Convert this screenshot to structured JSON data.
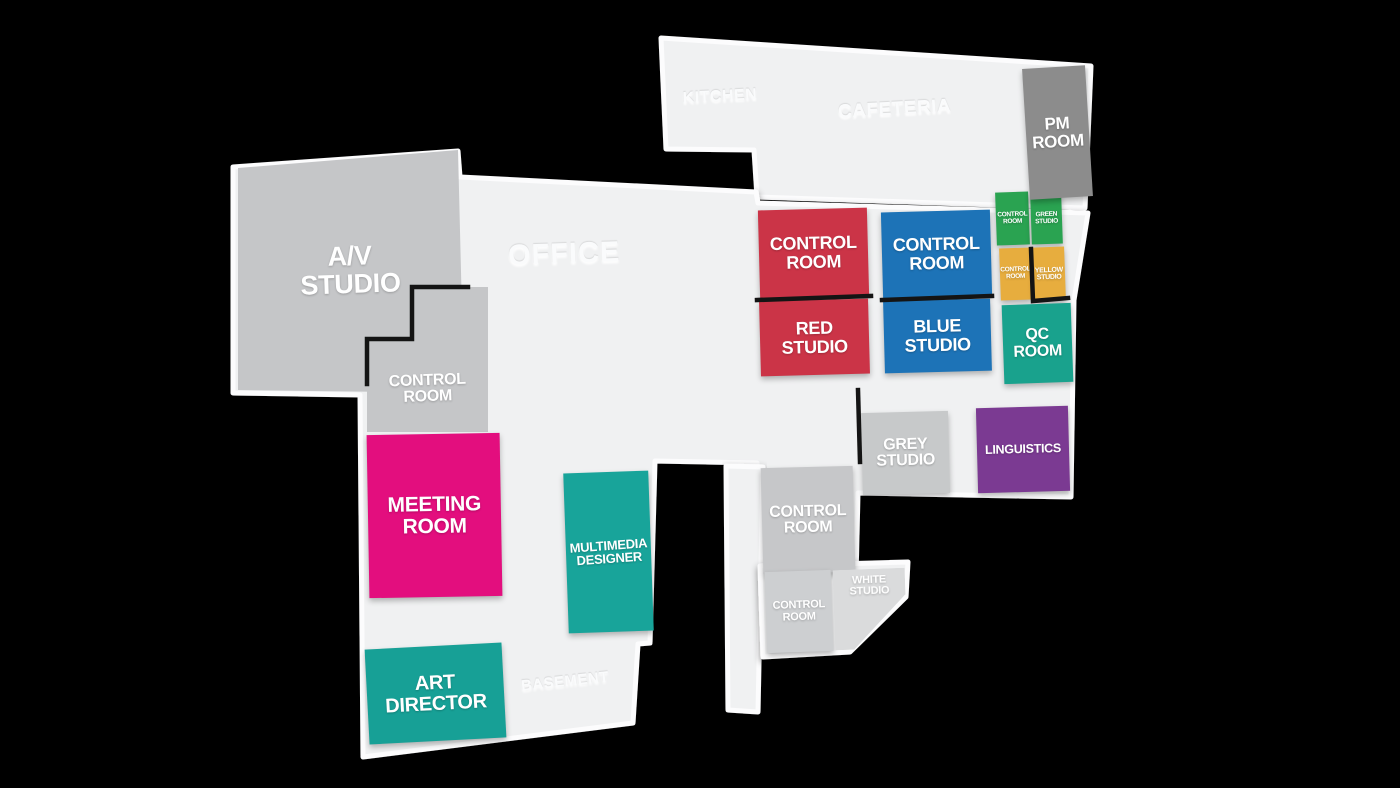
{
  "colors": {
    "background": "#000000",
    "floor": "#f0f1f2",
    "floor_edge": "#fcfcfd",
    "wall": "#141414"
  },
  "areas": {
    "kitchen": {
      "label": "KITCHEN"
    },
    "cafeteria": {
      "label": "CAFETERIA"
    },
    "office": {
      "label": "OFFICE"
    },
    "basement": {
      "label": "BASEMENT"
    }
  },
  "rooms": {
    "av_studio": {
      "label": "A/V\nSTUDIO",
      "color": "#c5c6c8"
    },
    "control_av": {
      "label": "CONTROL\nROOM",
      "color": "#c5c6c8"
    },
    "meeting_room": {
      "label": "MEETING\nROOM",
      "color": "#e30e7e"
    },
    "art_director": {
      "label": "ART\nDIRECTOR",
      "color": "#17a096"
    },
    "multimedia_designer": {
      "label": "MULTIMEDIA\nDESIGNER",
      "color": "#18a49a"
    },
    "control_red": {
      "label": "CONTROL\nROOM",
      "color": "#cb3447"
    },
    "red_studio": {
      "label": "RED\nSTUDIO",
      "color": "#cb3447"
    },
    "control_blue": {
      "label": "CONTROL\nROOM",
      "color": "#1d73b7"
    },
    "blue_studio": {
      "label": "BLUE\nSTUDIO",
      "color": "#1d73b7"
    },
    "control_green": {
      "label": "CONTROL\nROOM",
      "color": "#2aa351"
    },
    "green_studio": {
      "label": "GREEN\nSTUDIO",
      "color": "#2aa351"
    },
    "control_yellow": {
      "label": "CONTROL\nROOM",
      "color": "#e7ad3e"
    },
    "yellow_studio": {
      "label": "YELLOW\nSTUDIO",
      "color": "#e7ad3e"
    },
    "qc_room": {
      "label": "QC\nROOM",
      "color": "#19a28d"
    },
    "grey_studio": {
      "label": "GREY\nSTUDIO",
      "color": "#c7c9ca"
    },
    "linguistics": {
      "label": "LINGUISTICS",
      "color": "#7b3a92"
    },
    "control_grey_big": {
      "label": "CONTROL\nROOM",
      "color": "#c6c7c9"
    },
    "control_grey_small": {
      "label": "CONTROL\nROOM",
      "color": "#cdcfd1"
    },
    "white_studio": {
      "label": "WHITE\nSTUDIO",
      "color": "#dadbdc"
    },
    "pm_room": {
      "label": "PM\nROOM",
      "color": "#8c8c8c"
    }
  }
}
